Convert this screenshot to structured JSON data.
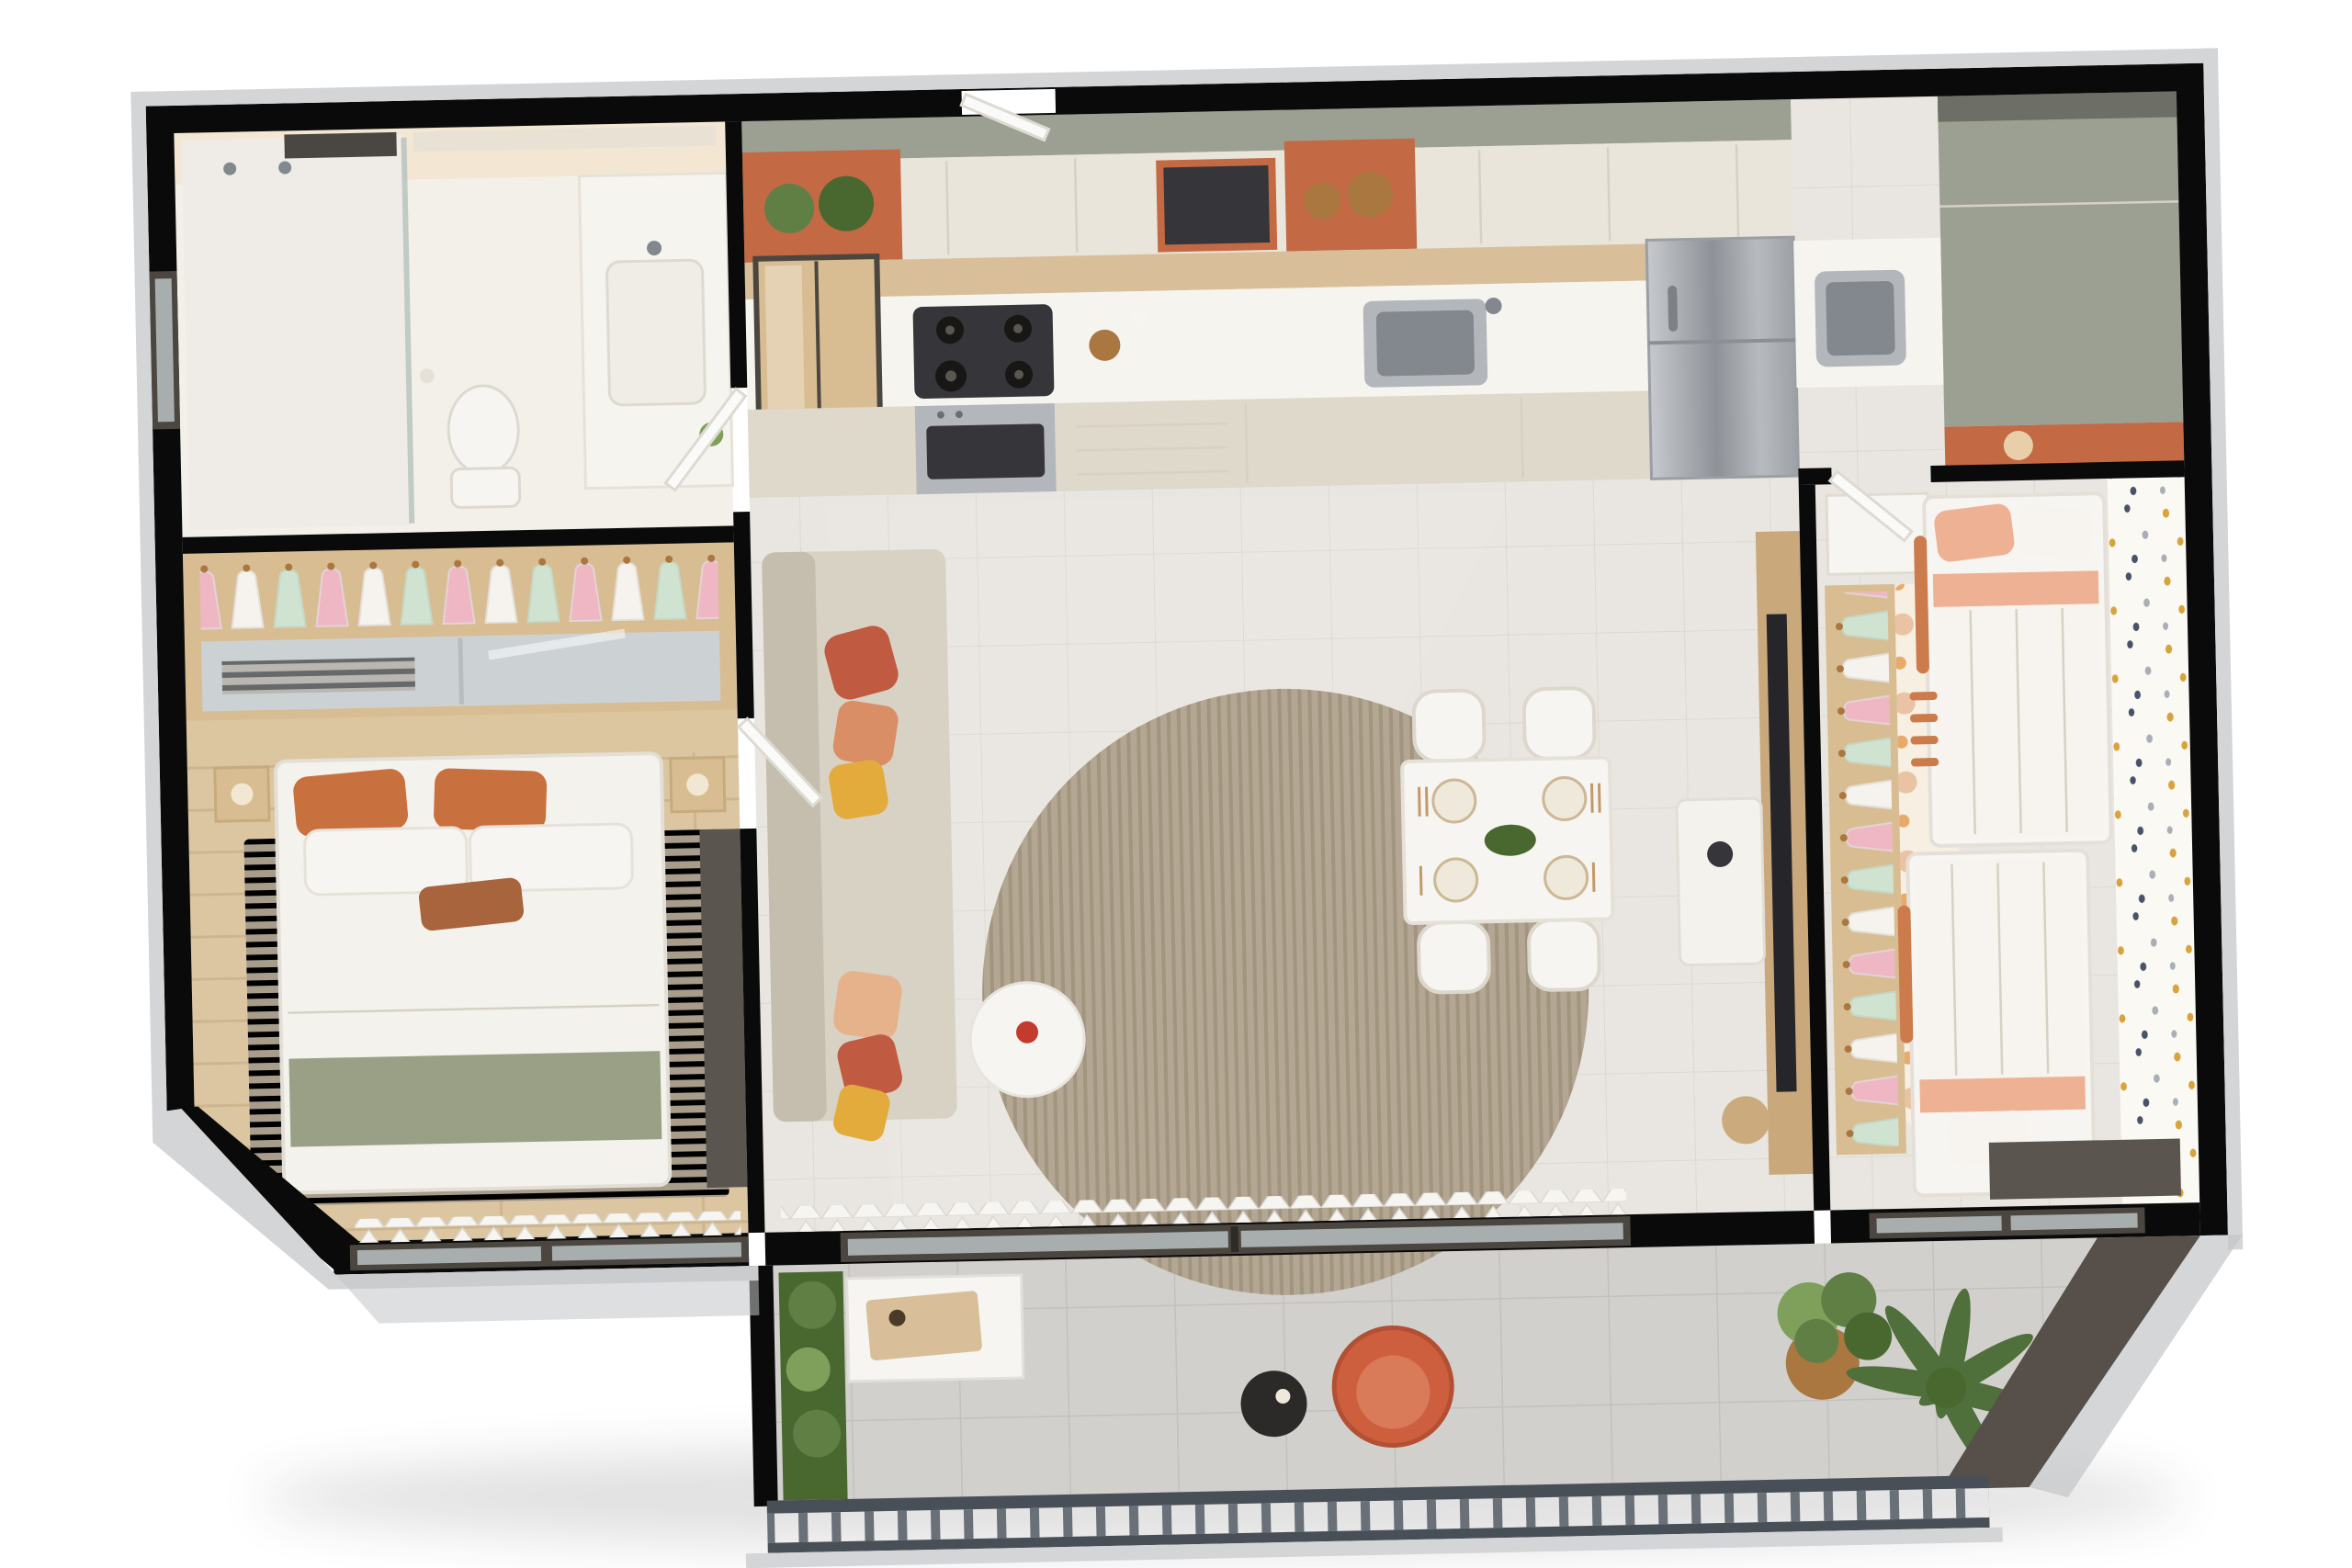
{
  "scene": {
    "type": "3d-floor-plan-render",
    "view": "top-down-cutaway",
    "rooms": [
      {
        "name": "bathroom",
        "objects": [
          "shower",
          "glass-partition",
          "window",
          "towel-shelf",
          "toilet",
          "vanity-sink",
          "mirror-cabinet"
        ]
      },
      {
        "name": "master-closet",
        "objects": [
          "hanging-clothes",
          "mirrored-sliding-doors",
          "wood-shelves"
        ]
      },
      {
        "name": "master-bedroom",
        "objects": [
          "double-bed",
          "orange-pillows",
          "sage-quilt",
          "nightstands",
          "striped-rug",
          "wood-floor",
          "dark-wardrobe",
          "window",
          "sheer-curtain"
        ]
      },
      {
        "name": "kitchen",
        "objects": [
          "upper-cabinets",
          "terracotta-niches",
          "potted-plants",
          "baskets",
          "microwave",
          "glass-display-cabinet",
          "gas-cooktop",
          "built-in-oven",
          "countertop",
          "steel-sink",
          "drawers",
          "refrigerator"
        ]
      },
      {
        "name": "laundry",
        "objects": [
          "counter",
          "steel-tank-sink",
          "tall-sage-cabinet",
          "terracotta-accent"
        ]
      },
      {
        "name": "living-room",
        "objects": [
          "sectional-sofa",
          "throw-pillows",
          "round-rug",
          "round-side-table",
          "flower-vase",
          "tv-wood-panel",
          "tv",
          "media-console",
          "sheer-curtain",
          "sliding-glass-door"
        ]
      },
      {
        "name": "dining-area",
        "objects": [
          "dining-table",
          "four-chairs",
          "place-settings",
          "floral-centerpiece"
        ]
      },
      {
        "name": "kids-bedroom",
        "objects": [
          "two-beds",
          "guard-rails",
          "ladder",
          "open-closet",
          "hanging-clothes",
          "polka-dot-rug",
          "polka-dot-wallpaper",
          "dresser",
          "desk",
          "windows"
        ]
      },
      {
        "name": "balcony",
        "objects": [
          "vertical-garden",
          "bench",
          "serving-board",
          "coral-armchair",
          "black-side-table",
          "potted-plant",
          "palm-plant",
          "metal-railing",
          "tile-floor"
        ]
      }
    ]
  },
  "palette": {
    "bg": "#ffffff",
    "wall": "#0a0a0a",
    "trim": "#d4d5d7",
    "trim2": "#c3c4c7",
    "white": "#f7f5f1",
    "counter": "#f6f4ee",
    "cabcream": "#e9e5da",
    "cabcream2": "#ded9cb",
    "cabtop": "#9ba092",
    "terra": "#c36944",
    "woodback": "#d8bf99",
    "steel": "#b3b7bc",
    "steeldark": "#83888e",
    "glassdark": "#35353a",
    "burner": "#191715",
    "tile": "#e9e6e1",
    "grout": "#dcd8d2",
    "glossy": "#ffffff",
    "woodfloor": "#dcc6a2",
    "woodstripe": "#cdb58d",
    "bathfloor": "#f3f0ea",
    "bathglow": "#f3e7d3",
    "sofa": "#d8d2c5",
    "sofadark": "#c5beae",
    "pilcoral": "#c05a41",
    "pilstripe": "#d98e66",
    "pilyellow": "#e3aa3c",
    "pilpeach": "#e6b28c",
    "ruground": "#b3a692",
    "ruground2": "#a2957f",
    "ruggray": "#a89c8b",
    "ruggray2": "#97College8a7a",
    "tvwood": "#c9a87c",
    "tvdark": "#25252a",
    "console": "#f4f2ec",
    "wallpaper": "#fbf9f4",
    "dot1": "#d8a33c",
    "dot2": "#4a5269",
    "dot3": "#a9aeb8",
    "polkabg": "#f7efe2",
    "polka1": "#dd8a4e",
    "polka2": "#e7aa6a",
    "polka3": "#e9c3a4",
    "kidpeach": "#efb194",
    "kidlight": "#f6cfb9",
    "kidwhite": "#f7f4ef",
    "kidrail": "#cc7b4c",
    "clothesA": "#efb6c3",
    "clothesB": "#f6f3ef",
    "clothesC": "#cfe3d0",
    "closetwood": "#d9bd92",
    "mirror": "#ccd2d4",
    "curtain": "#f6f5f2",
    "door": "#fafaf8",
    "doorframe": "#dddad3",
    "glassframe": "#4b463f",
    "glass": "#ccd6d8",
    "railing": "#494f57",
    "railslat": "#6a7078",
    "balfloor": "#d1d0cd",
    "balgrout": "#c2c1be",
    "charcoal": "#57504a",
    "charcoal2": "#5a564f",
    "green1": "#5f7f45",
    "green2": "#49682f",
    "green3": "#7fa05a",
    "palm": "#4f6f3b",
    "basket": "#a9773f",
    "chaircoral": "#cd5f3e",
    "sidetable": "#2c2a28",
    "bedduvet": "#f4f2ec",
    "bedsage": "#9aa086",
    "bedorange": "#c9703f",
    "leather": "#a8643c",
    "headboard": "#dcc6a0",
    "nightstand": "#d9bd92",
    "seamline": "#d6d1c4"
  }
}
